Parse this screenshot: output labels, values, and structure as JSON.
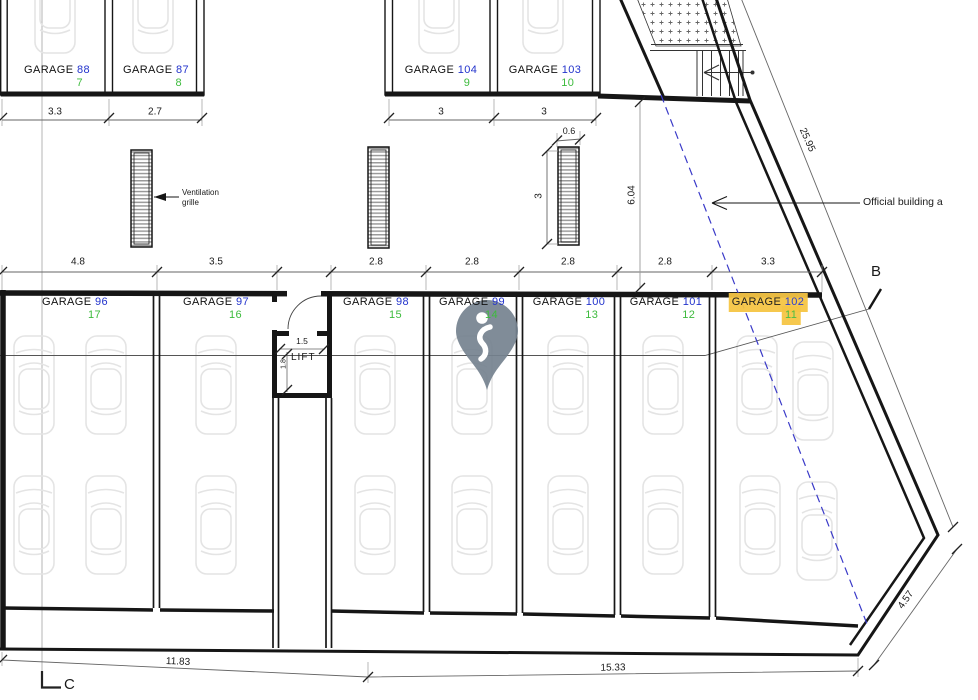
{
  "plan": {
    "garages_top": [
      {
        "label": "GARAGE",
        "number": "88",
        "unit": "7",
        "highlighted": false
      },
      {
        "label": "GARAGE",
        "number": "87",
        "unit": "8",
        "highlighted": false
      },
      {
        "label": "GARAGE",
        "number": "104",
        "unit": "9",
        "highlighted": false
      },
      {
        "label": "GARAGE",
        "number": "103",
        "unit": "10",
        "highlighted": false
      }
    ],
    "garages_main": [
      {
        "label": "GARAGE",
        "number": "96",
        "unit": "17",
        "highlighted": false
      },
      {
        "label": "GARAGE",
        "number": "97",
        "unit": "16",
        "highlighted": false
      },
      {
        "label": "GARAGE",
        "number": "98",
        "unit": "15",
        "highlighted": false
      },
      {
        "label": "GARAGE",
        "number": "99",
        "unit": "14",
        "highlighted": false
      },
      {
        "label": "GARAGE",
        "number": "100",
        "unit": "13",
        "highlighted": false
      },
      {
        "label": "GARAGE",
        "number": "101",
        "unit": "12",
        "highlighted": false
      },
      {
        "label": "GARAGE",
        "number": "102",
        "unit": "11",
        "highlighted": true
      }
    ],
    "rooms": {
      "lift": "LIFT"
    },
    "annotations": {
      "ventilation_grille": "Ventilation grille",
      "official_building": "Official building a",
      "section_marker_b": "B",
      "section_marker_c": "C"
    },
    "dimensions": {
      "top_left": [
        "3.3",
        "2.7"
      ],
      "top_mid": [
        "3",
        "3"
      ],
      "grille_width": "0.6",
      "grille_height": "3",
      "main_row": [
        "4.8",
        "3.5",
        "2.8",
        "2.8",
        "2.8",
        "2.8",
        "3.3"
      ],
      "lift_width": "1.5",
      "lift_depth": "1.8",
      "aisle_depth": "6.04",
      "boundary_length": "25.95",
      "bottom_left": "11.83",
      "bottom_right": "15.33",
      "corner_edge": "4.57"
    },
    "colors": {
      "garage_number": "#2233cc",
      "unit_number": "#3dbb3d",
      "highlight": "#f6c544",
      "boundary_dashed": "#3a3ac8",
      "pin": "#75828f"
    }
  }
}
